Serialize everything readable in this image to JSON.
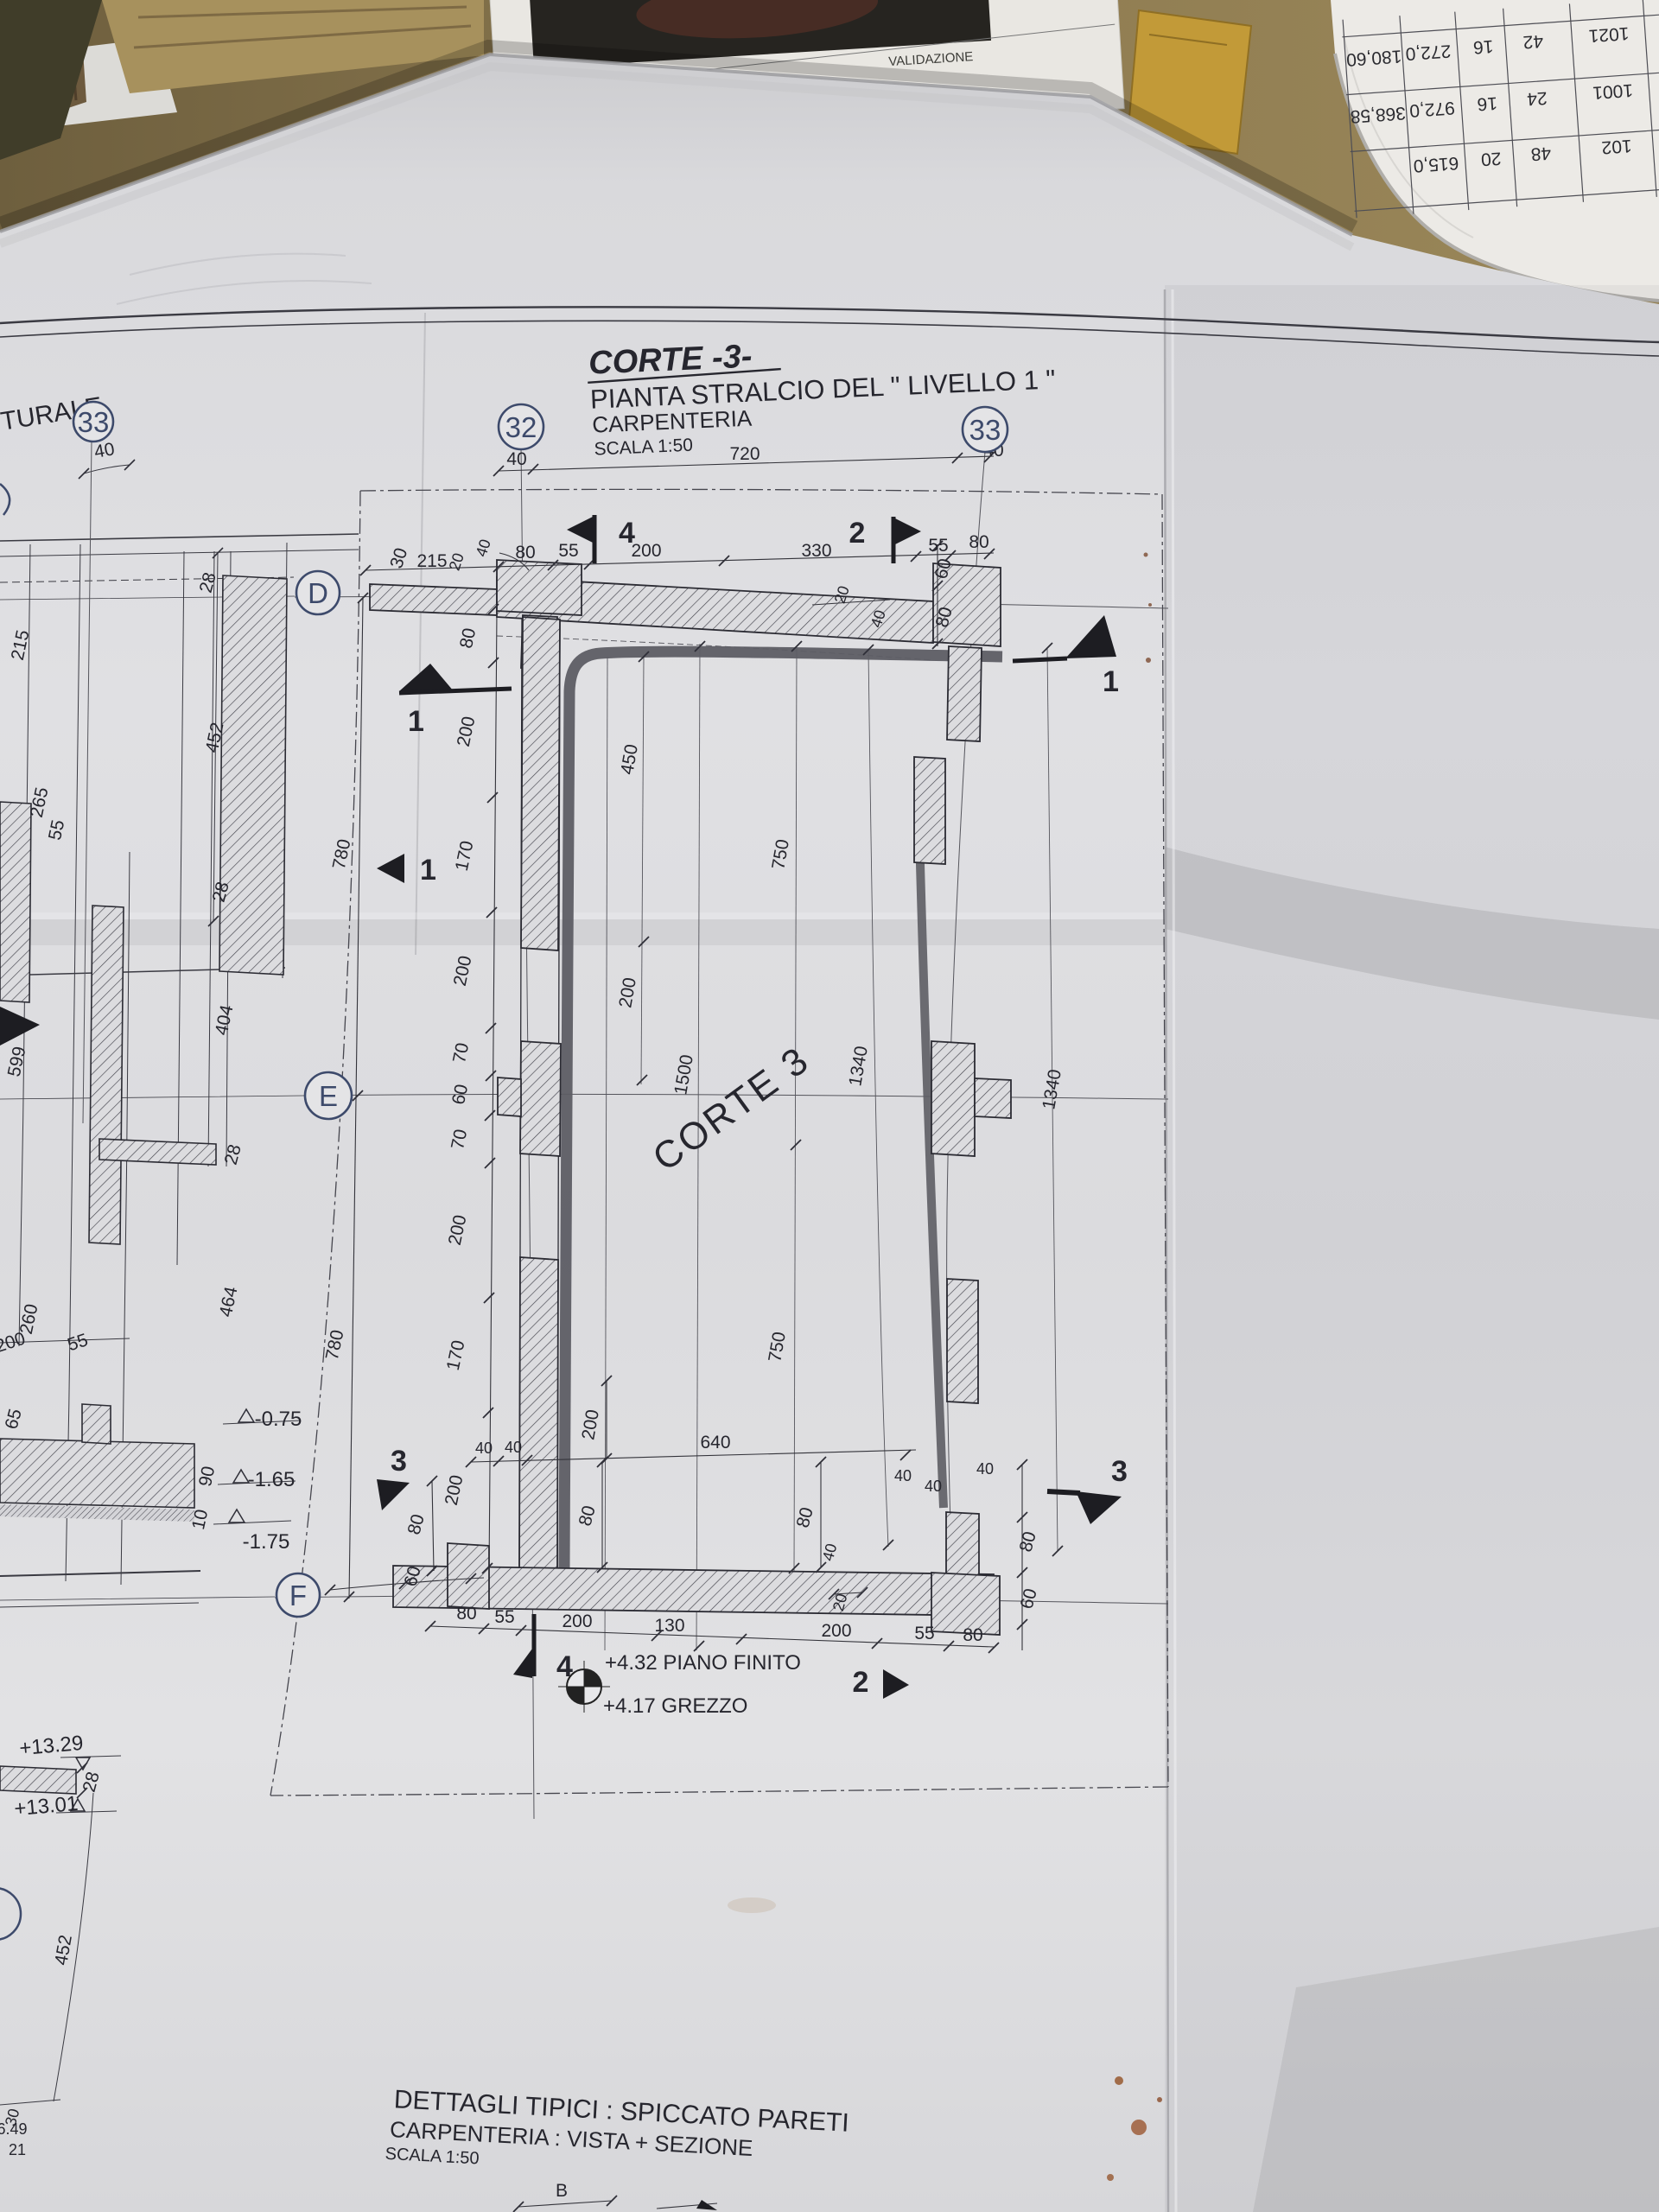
{
  "docs": {
    "regione": "REGIONE CALABRIA",
    "validazione": "VALIDAZIONE"
  },
  "table": {
    "r1": [
      "1021",
      "42",
      "16",
      "272,0",
      "180,60"
    ],
    "r2": [
      "1001",
      "24",
      "16",
      "972,0",
      "368,58"
    ],
    "r3": [
      "102",
      "48",
      "20",
      "615,0"
    ]
  },
  "plan": {
    "grid": {
      "c33l": "33",
      "c32": "32",
      "c33r": "33",
      "rD": "D",
      "rE": "E",
      "rF": "F"
    },
    "title": {
      "t1": "CORTE -3-",
      "t2": "PIANTA STRALCIO DEL \" LIVELLO 1 \"",
      "t3": "CARPENTERIA",
      "t4": "SCALA 1:50"
    },
    "corte_label": "CORTE 3",
    "left_fragment": "TTURALE"
  },
  "bottom_block": {
    "l1": "DETTAGLI TIPICI : SPICCATO PARETI",
    "l2": "CARPENTERIA : VISTA + SEZIONE",
    "l3": "SCALA 1:50",
    "dim_b": "B"
  },
  "flags": {
    "f1": "1",
    "f2": "2",
    "f3": "3",
    "f4": "4"
  },
  "levels": {
    "p432": "+4.32  PIANO FINITO",
    "p417": "+4.17  GREZZO",
    "m075": "-0.75",
    "m165": "-1.65",
    "m175": "-1.75",
    "p1329": "+13.29",
    "p1301": "+13.01",
    "p649": "6.49",
    "v21": "21"
  },
  "dim": {
    "v10": "10",
    "v20": "20",
    "v28": "28",
    "v30": "30",
    "v40": "40",
    "v55": "55",
    "v60": "60",
    "v65": "65",
    "v70": "70",
    "v80": "80",
    "v90": "90",
    "v130": "130",
    "v170": "170",
    "v200": "200",
    "v215": "215",
    "v260": "260",
    "v265": "265",
    "v330": "330",
    "v404": "404",
    "v450": "450",
    "v452": "452",
    "v464": "464",
    "v599": "599",
    "v640": "640",
    "v720": "720",
    "v750": "750",
    "v780": "780",
    "v1340": "1340",
    "v1500": "1500"
  }
}
